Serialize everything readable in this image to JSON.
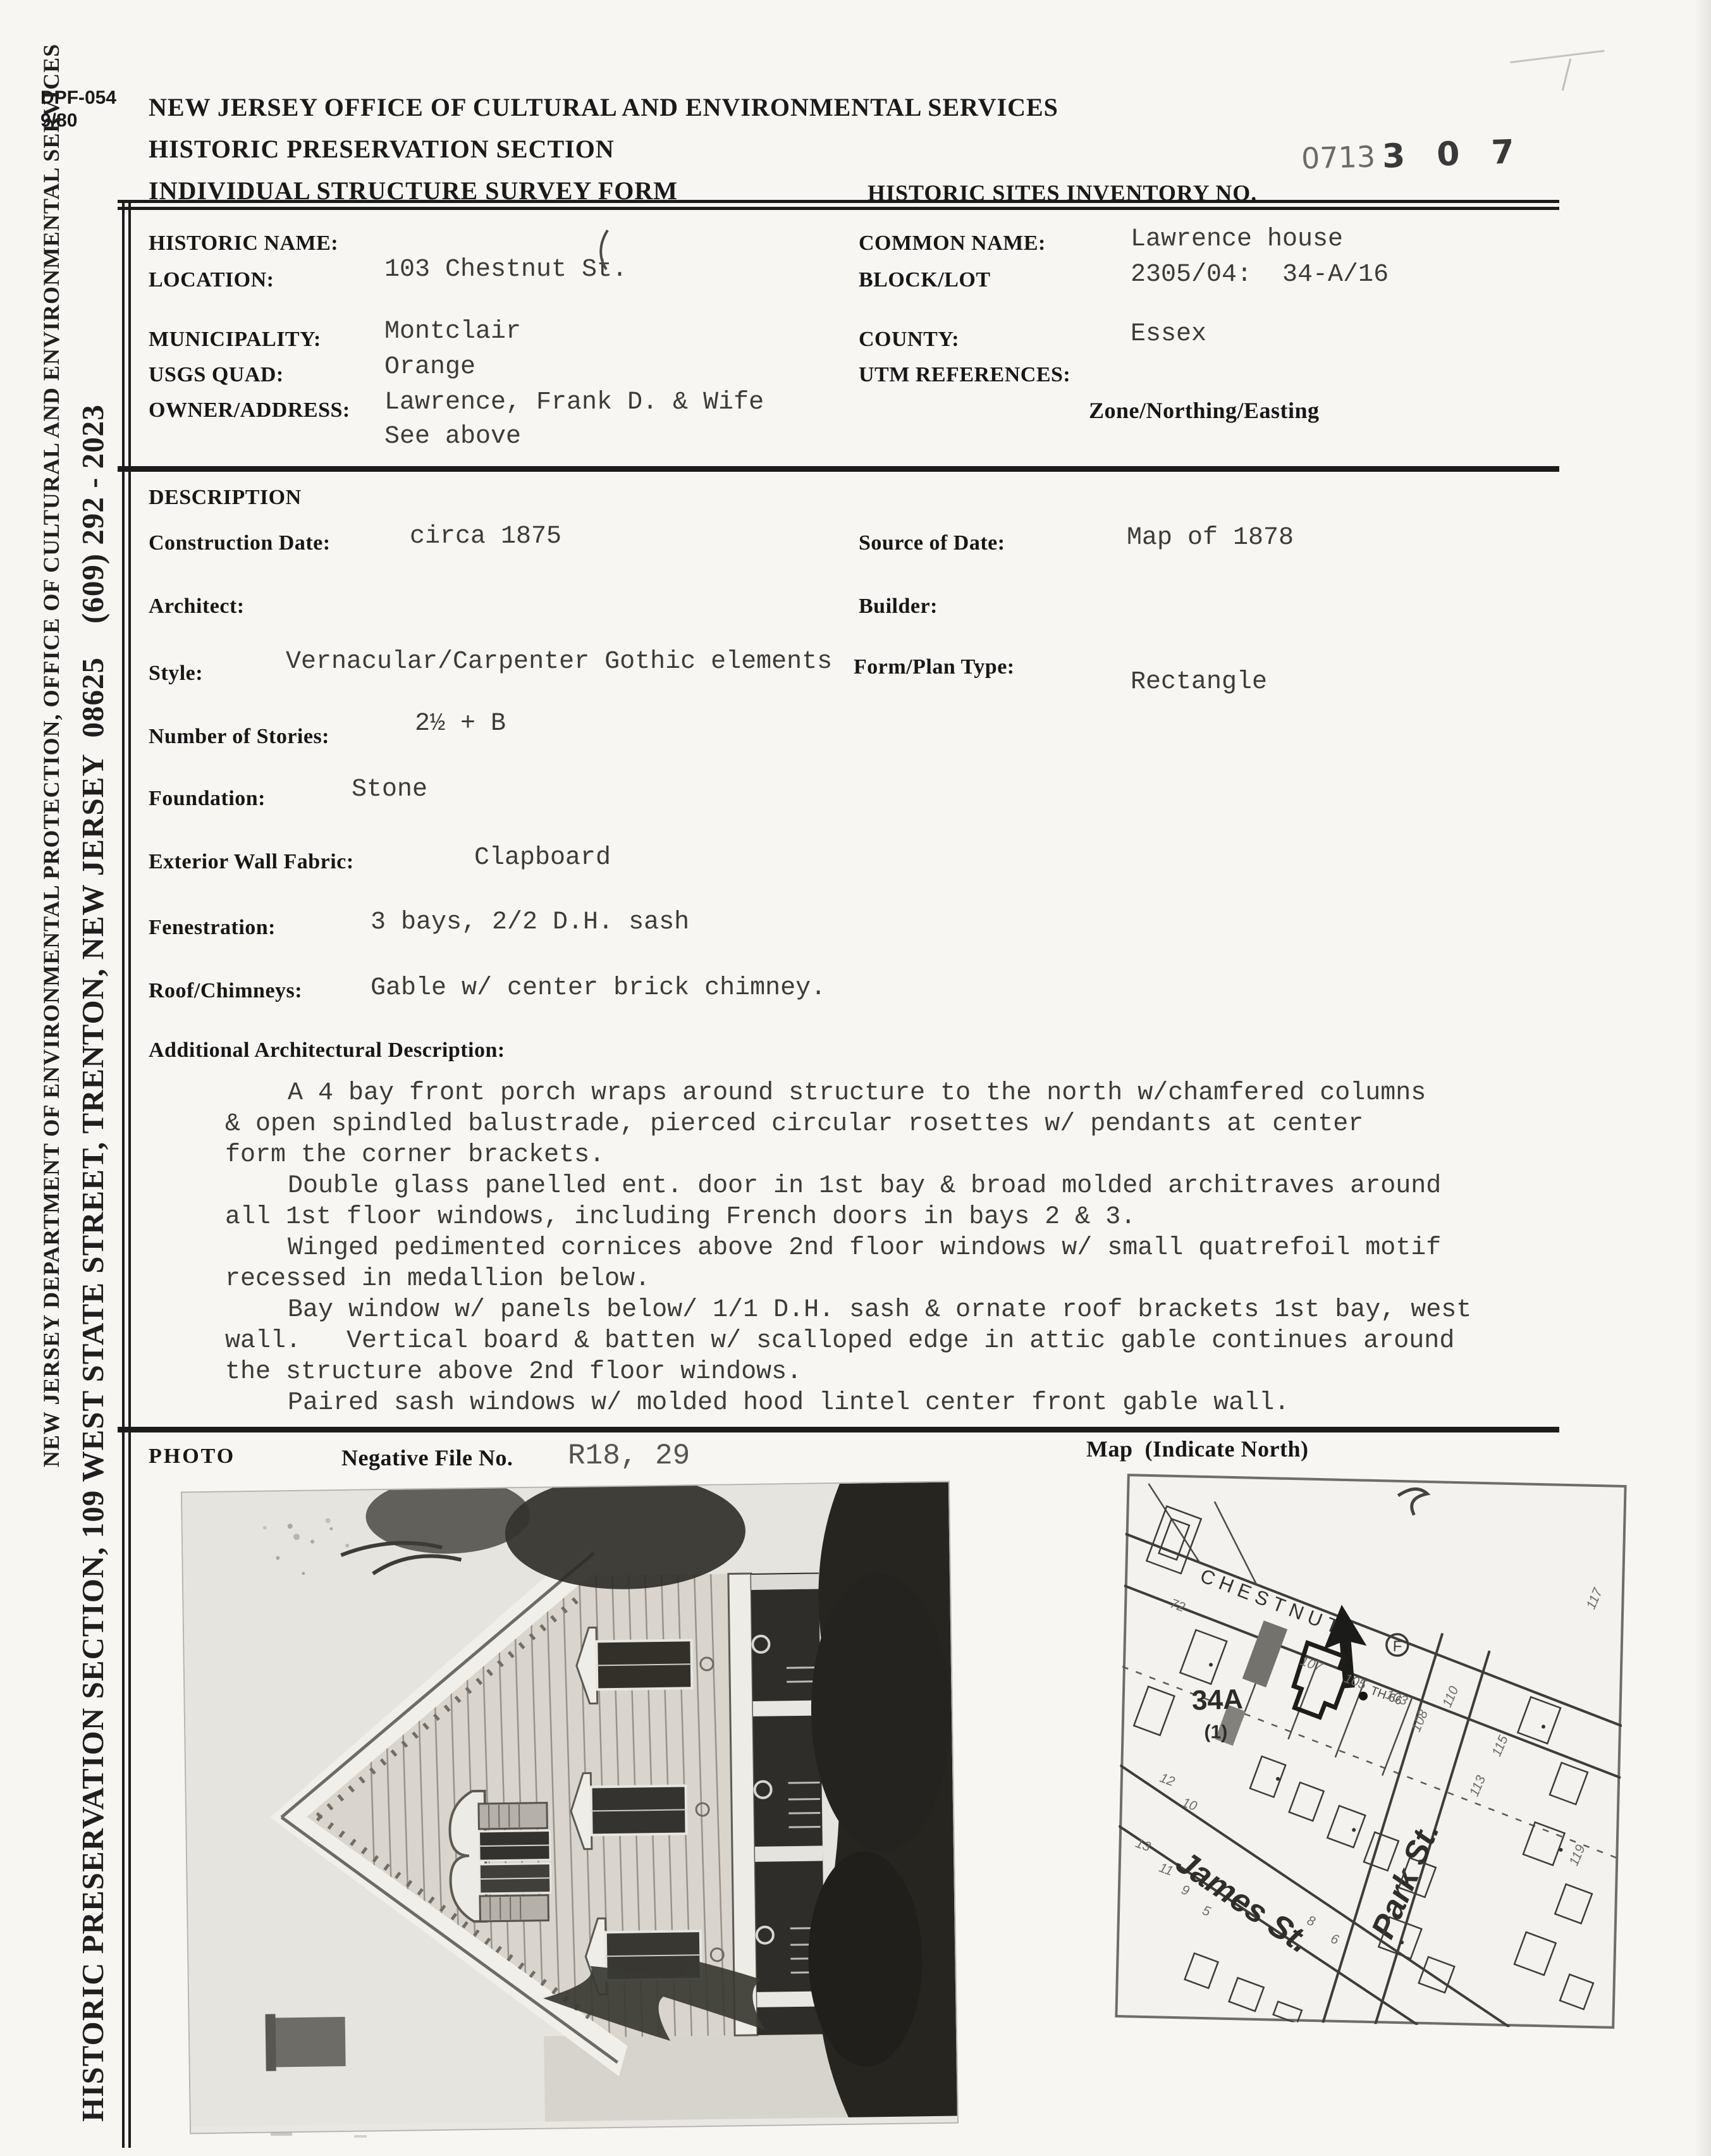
{
  "form": {
    "code": "DPF-054",
    "code_date": "9/80",
    "agency_line1": "NEW JERSEY OFFICE OF CULTURAL AND ENVIRONMENTAL SERVICES",
    "agency_line2": "HISTORIC PRESERVATION SECTION",
    "agency_line3": "INDIVIDUAL STRUCTURE SURVEY FORM",
    "inventory_label": "HISTORIC SITES INVENTORY NO.",
    "inventory_prefix": "0713",
    "inventory_number": "3 0 7"
  },
  "sidebar": {
    "line1": "NEW JERSEY DEPARTMENT OF ENVIRONMENTAL PROTECTION, OFFICE OF CULTURAL AND ENVIRONMENTAL SERVICES",
    "line2": "HISTORIC PRESERVATION SECTION, 109 WEST STATE STREET, TRENTON, NEW JERSEY  08625    (609) 292 - 2023"
  },
  "identification": {
    "historic_name_label": "HISTORIC NAME:",
    "location_label": "LOCATION:",
    "location_value": "103 Chestnut St.",
    "common_name_label": "COMMON NAME:",
    "common_name_value": "Lawrence house",
    "block_lot_label": "BLOCK/LOT",
    "block_lot_value": "2305/04:  34-A/16",
    "municipality_label": "MUNICIPALITY:",
    "municipality_value": "Montclair",
    "usgs_quad_label": "USGS QUAD:",
    "usgs_quad_value": "Orange",
    "owner_label": "OWNER/ADDRESS:",
    "owner_value_line1": "Lawrence, Frank D. & Wife",
    "owner_value_line2": "See above",
    "county_label": "COUNTY:",
    "county_value": "Essex",
    "utm_label": "UTM REFERENCES:",
    "utm_sublabel": "Zone/Northing/Easting"
  },
  "description": {
    "section_label": "DESCRIPTION",
    "construction_date_label": "Construction Date:",
    "construction_date_value": "circa 1875",
    "source_label": "Source of Date:",
    "source_value": "Map of 1878",
    "architect_label": "Architect:",
    "builder_label": "Builder:",
    "style_label": "Style:",
    "style_value": "Vernacular/Carpenter Gothic elements",
    "form_plan_label": "Form/Plan Type:",
    "form_plan_value": "Rectangle",
    "stories_label": "Number of Stories:",
    "stories_value": "2½ + B",
    "foundation_label": "Foundation:",
    "foundation_value": "Stone",
    "wall_label": "Exterior Wall Fabric:",
    "wall_value": "Clapboard",
    "fenestration_label": "Fenestration:",
    "fenestration_value": "3 bays, 2/2 D.H. sash",
    "roof_label": "Roof/Chimneys:",
    "roof_value": "Gable w/ center brick chimney."
  },
  "additional": {
    "label": "Additional Architectural Description:",
    "lines": [
      "A 4 bay front porch wraps around structure to the north w/chamfered columns",
      "& open spindled balustrade, pierced circular rosettes w/ pendants at center",
      "form the corner brackets.",
      "Double glass panelled ent. door in 1st bay & broad molded architraves around",
      "all 1st floor windows, including French doors in bays 2 & 3.",
      "Winged pedimented cornices above 2nd floor windows w/ small quatrefoil motif",
      "recessed in medallion below.",
      "Bay window w/ panels below/ 1/1 D.H. sash & ornate roof brackets 1st bay, west",
      "wall.   Vertical board & batten w/ scalloped edge in attic gable continues around",
      "the structure above 2nd floor windows.",
      "Paired sash windows w/ molded hood lintel center front gable wall."
    ]
  },
  "photo": {
    "section_label": "PHOTO",
    "negative_label": "Negative File No.",
    "negative_value": "R18, 29"
  },
  "map": {
    "section_label": "Map  (Indicate North)",
    "street_chestnut": "CHESTNUT",
    "street_james": "James St.",
    "street_park": "Park St.",
    "parcel_label": "34A",
    "parcel_sublabel": "(1)",
    "landmark": "F",
    "north_note": "TH 66",
    "lots": [
      "107",
      "105",
      "103",
      "110",
      "108",
      "115",
      "113",
      "117",
      "119",
      "72",
      "12",
      "10",
      "13",
      "11",
      "9",
      "5",
      "8",
      "6"
    ]
  }
}
